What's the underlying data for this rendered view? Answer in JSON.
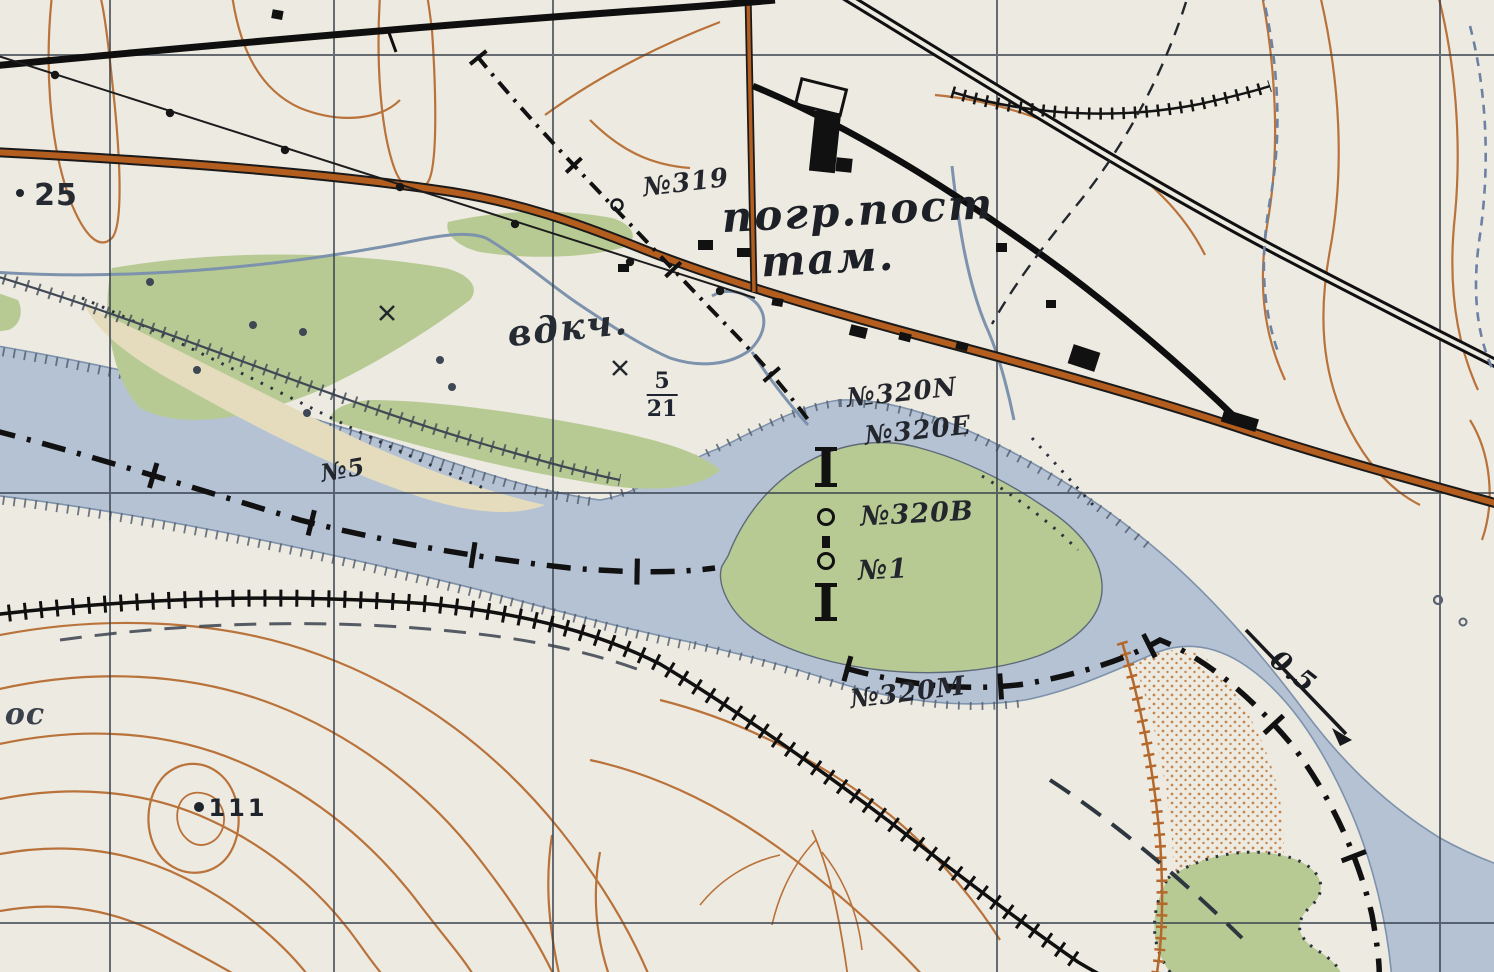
{
  "map": {
    "title": "Topographic map fragment (river border sector)",
    "colors": {
      "paper": "#edeae1",
      "water": "#b5c2d4",
      "water_line": "#7d92ac",
      "veg": "#b7ca93",
      "sand": "#e4dcbd",
      "contour": "#b4682c",
      "grid": "#39414e",
      "ink": "#14161a",
      "road": "#b35d1f",
      "label_ink": "#23262c"
    },
    "features": [
      "state-border-line",
      "border-marker-posts",
      "railway",
      "surfaced-highway",
      "black-road",
      "power-line-with-dots",
      "river",
      "river-island",
      "flood-dike-with-hachures",
      "fence-hachured-line",
      "contour-lines",
      "spot-heights",
      "buildings",
      "coordinate-grid",
      "flow-direction-arrow",
      "sand-stipple",
      "vegetation-areas",
      "intermittent-streams"
    ],
    "labels": [
      {
        "id": "spot-25",
        "text": "25",
        "x": 56,
        "y": 196,
        "size": 30,
        "rot": 0,
        "italic": false,
        "sans": true,
        "weight": 600,
        "color": "#262b33",
        "ls": 1
      },
      {
        "id": "no319",
        "text": "№319",
        "x": 686,
        "y": 183,
        "size": 26,
        "rot": -7,
        "italic": true,
        "sans": false,
        "weight": 600,
        "color": "#23262c",
        "ls": 1
      },
      {
        "id": "pogr-post",
        "text": "погр.пост",
        "x": 858,
        "y": 211,
        "size": 42,
        "rot": -3,
        "italic": true,
        "sans": false,
        "weight": 700,
        "color": "#1d2026",
        "ls": 2
      },
      {
        "id": "tam",
        "text": "там.",
        "x": 828,
        "y": 259,
        "size": 42,
        "rot": -3,
        "italic": true,
        "sans": false,
        "weight": 700,
        "color": "#1d2026",
        "ls": 2
      },
      {
        "id": "vdkch",
        "text": "вдкч.",
        "x": 568,
        "y": 328,
        "size": 36,
        "rot": -6,
        "italic": true,
        "sans": false,
        "weight": 600,
        "color": "#262b33",
        "ls": 2
      },
      {
        "id": "frac-5-21",
        "top": "5",
        "bottom": "21",
        "x": 662,
        "y": 395,
        "size": 22,
        "rot": 0,
        "italic": false,
        "sans": false,
        "weight": 600,
        "color": "#202631",
        "ls": 0
      },
      {
        "id": "no320n",
        "text": "№320N",
        "x": 902,
        "y": 393,
        "size": 26,
        "rot": -6,
        "italic": true,
        "sans": false,
        "weight": 600,
        "color": "#23262c",
        "ls": 1
      },
      {
        "id": "no320e",
        "text": "№320E",
        "x": 918,
        "y": 431,
        "size": 26,
        "rot": -6,
        "italic": true,
        "sans": false,
        "weight": 600,
        "color": "#23262c",
        "ls": 1
      },
      {
        "id": "no320v",
        "text": "№320В",
        "x": 917,
        "y": 514,
        "size": 27,
        "rot": -3,
        "italic": true,
        "sans": false,
        "weight": 600,
        "color": "#23262c",
        "ls": 1
      },
      {
        "id": "no1",
        "text": "№1",
        "x": 883,
        "y": 570,
        "size": 27,
        "rot": -3,
        "italic": true,
        "sans": false,
        "weight": 600,
        "color": "#23262c",
        "ls": 1
      },
      {
        "id": "no320m",
        "text": "№320М",
        "x": 908,
        "y": 693,
        "size": 26,
        "rot": -7,
        "italic": true,
        "sans": false,
        "weight": 600,
        "color": "#23262c",
        "ls": 1
      },
      {
        "id": "no5",
        "text": "№5",
        "x": 343,
        "y": 470,
        "size": 24,
        "rot": -10,
        "italic": true,
        "sans": false,
        "weight": 600,
        "color": "#23262c",
        "ls": 1
      },
      {
        "id": "flow-speed",
        "text": "0.5",
        "x": 1293,
        "y": 672,
        "size": 27,
        "rot": 38,
        "italic": true,
        "sans": false,
        "weight": 700,
        "color": "#191c21",
        "ls": 1
      },
      {
        "id": "os",
        "text": "ос",
        "x": 25,
        "y": 715,
        "size": 30,
        "rot": 0,
        "italic": true,
        "sans": false,
        "weight": 600,
        "color": "#3a414c",
        "ls": 1
      },
      {
        "id": "spot-111",
        "text": "111",
        "x": 238,
        "y": 808,
        "size": 24,
        "rot": 0,
        "italic": false,
        "sans": true,
        "weight": 700,
        "color": "#20242c",
        "ls": 3
      }
    ]
  }
}
